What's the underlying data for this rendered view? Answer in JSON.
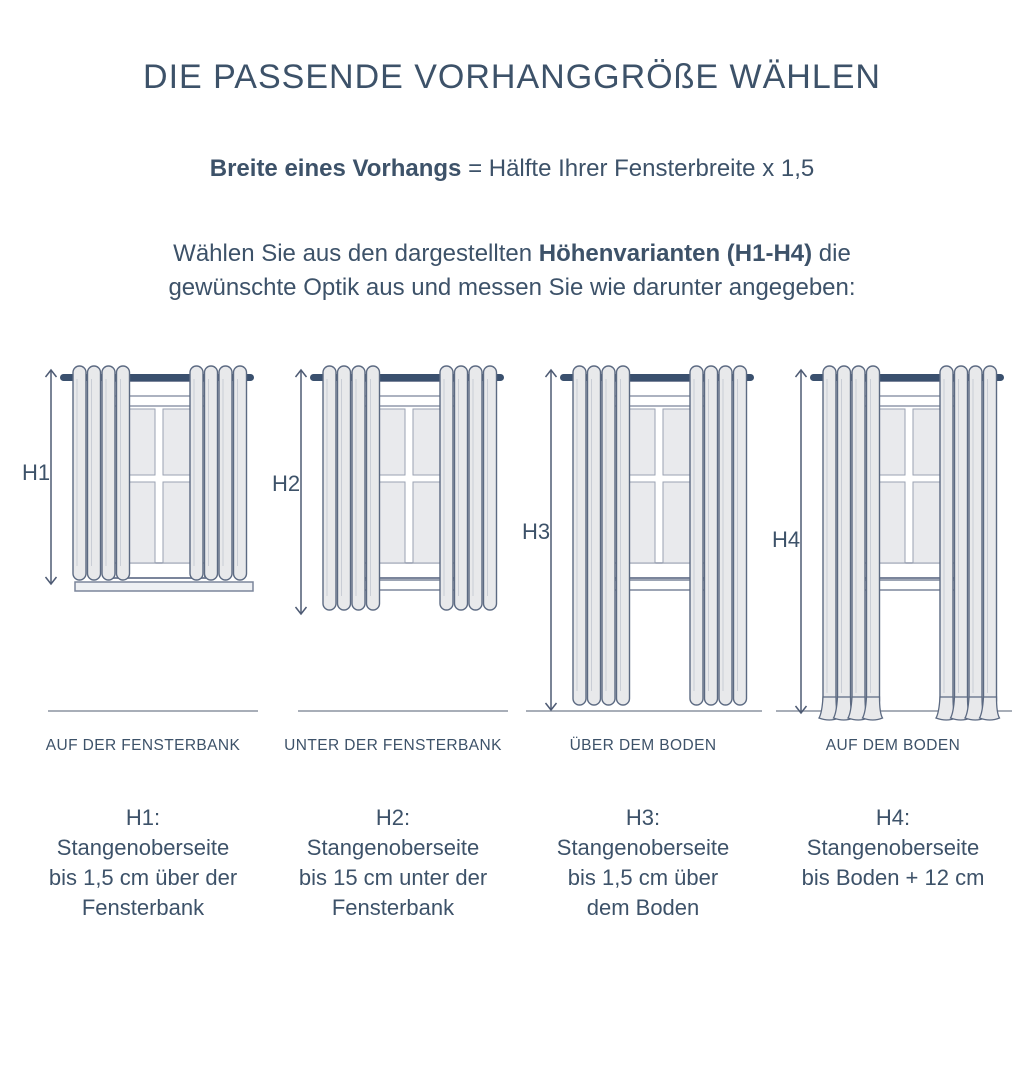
{
  "title": "DIE PASSENDE VORHANGGRÖßE WÄHLEN",
  "formula": {
    "bold": "Breite eines Vorhangs",
    "rest": "= Hälfte Ihrer Fensterbreite x 1,5"
  },
  "intro": {
    "before": "Wählen Sie aus den dargestellten ",
    "bold": "Höhenvarianten (H1-H4)",
    "after": " die gewünschte Optik aus und messen Sie wie darunter angegeben:"
  },
  "colors": {
    "text_navy": "#3d5269",
    "rod_navy": "#3a506e",
    "curtain_fill": "#e8e9eb",
    "curtain_stroke": "#5c6a82",
    "curtain_fold": "#c9cdd5",
    "window_frame": "#7b859b",
    "pane_fill": "#e9eaed",
    "pane_stroke": "#9aa2b2",
    "baseline_gray": "#8b93a1",
    "arrow": "#4e5b74",
    "sill_fill": "#eef0f3"
  },
  "variants": [
    {
      "label": "H1",
      "caption": "AUF DER FENSTERBANK",
      "description": [
        "H1:",
        "Stangenoberseite",
        "bis 1,5 cm über der",
        "Fensterbank"
      ],
      "diagram": {
        "curtain_bottom": 219,
        "arrow_bottom": 223,
        "sill": "wide",
        "floor_line": false,
        "drape": false,
        "label_y": 119
      }
    },
    {
      "label": "H2",
      "caption": "UNTER DER FENSTERBANK",
      "description": [
        "H2:",
        "Stangenoberseite",
        "bis 15 cm unter der",
        "Fensterbank"
      ],
      "diagram": {
        "curtain_bottom": 249,
        "arrow_bottom": 253,
        "sill": "inner",
        "floor_line": false,
        "drape": false,
        "label_y": 130
      }
    },
    {
      "label": "H3",
      "caption": "ÜBER DEM BODEN",
      "description": [
        "H3:",
        "Stangenoberseite",
        "bis 1,5 cm über",
        "dem Boden"
      ],
      "diagram": {
        "curtain_bottom": 344,
        "arrow_bottom": 349,
        "sill": "inner",
        "floor_line": true,
        "drape": false,
        "label_y": 178
      }
    },
    {
      "label": "H4",
      "caption": "AUF DEM BODEN",
      "description": [
        "H4:",
        "Stangenoberseite",
        "bis Boden + 12 cm"
      ],
      "diagram": {
        "curtain_bottom": 346,
        "arrow_bottom": 352,
        "sill": "inner",
        "floor_line": true,
        "drape": true,
        "label_y": 186
      }
    }
  ]
}
